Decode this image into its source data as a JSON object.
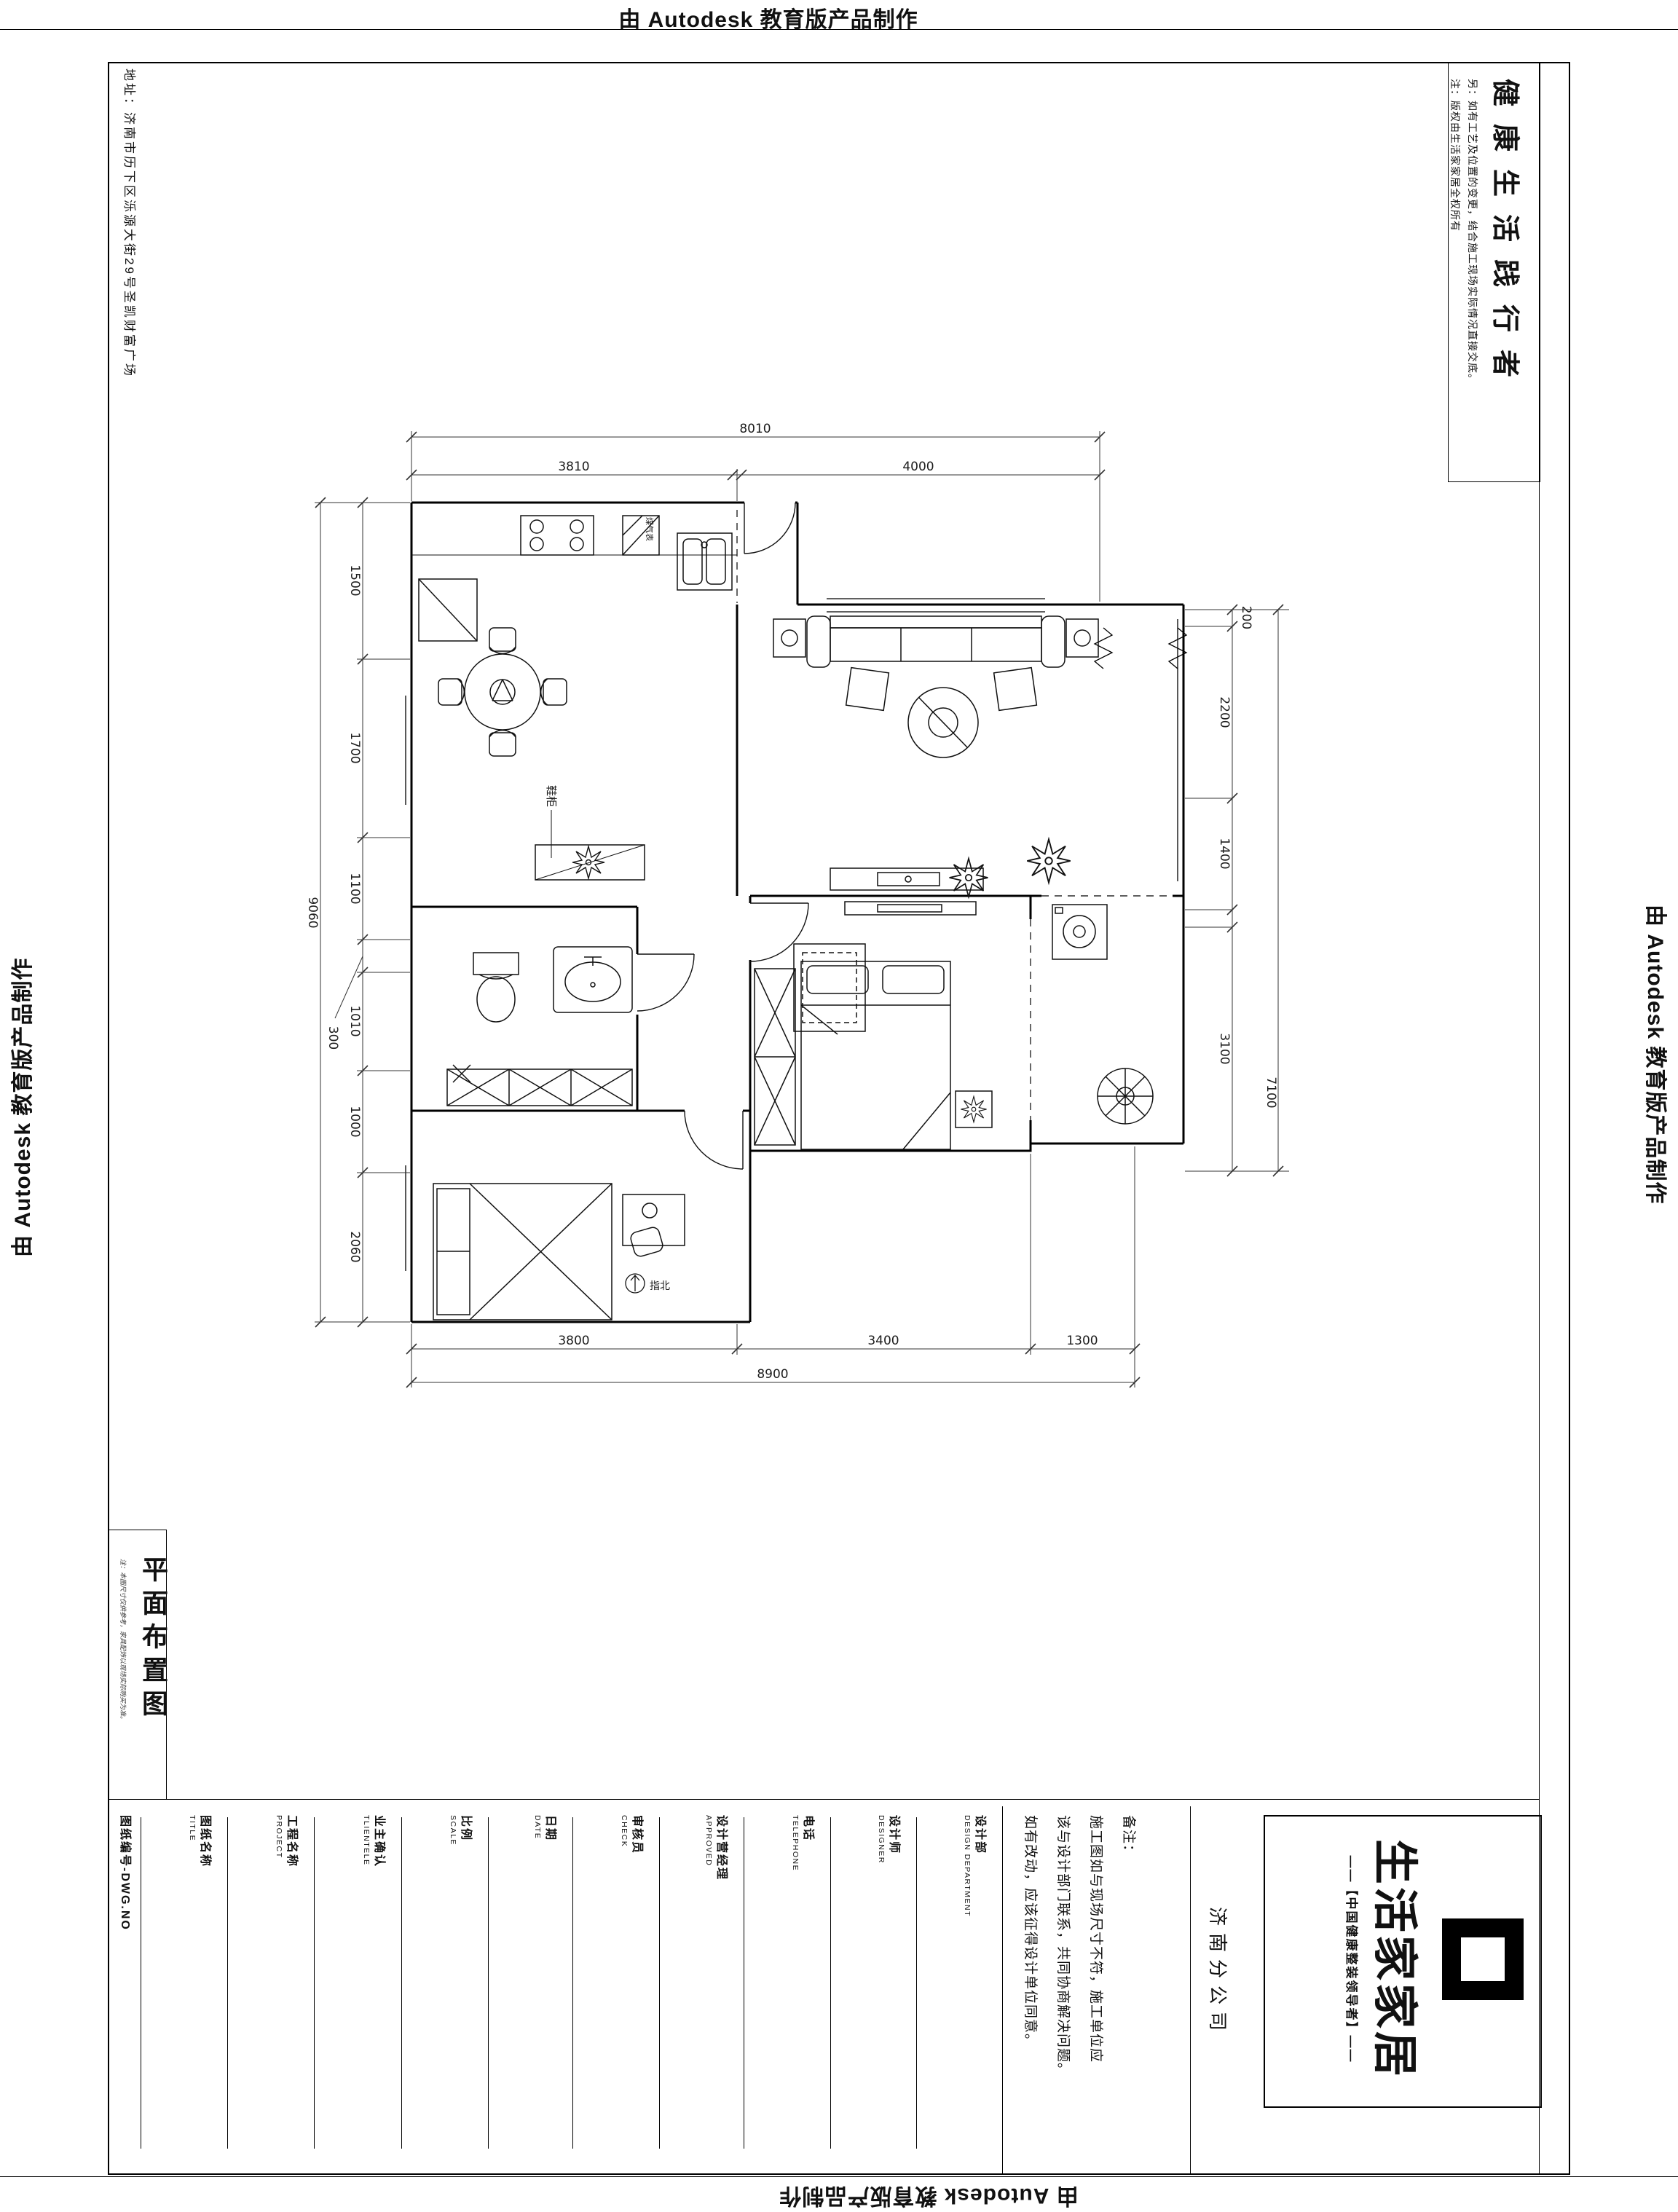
{
  "credit": "由 Autodesk 教育版产品制作",
  "address": "地址：济南市历下区泺源大街29号圣凯财富广场",
  "slogan": {
    "title": "健康生活践行者",
    "note1": "另：如有工艺及位置的变更，结合施工现场实际情况直接交底。",
    "note2": "注：版权由生活家家居全权所有"
  },
  "sidebar": {
    "drawing_title": "平面布置图",
    "note": "注：本图尺寸仅供参考，家具配饰以现场实际购买为准。"
  },
  "plan": {
    "labels": {
      "shoe_cabinet": "鞋柜",
      "gas_meter": "煤气表",
      "north": "指北"
    },
    "dims": {
      "top_total": "8010",
      "top_segs": [
        "3810",
        "4000"
      ],
      "bottom_segs": [
        "3800",
        "3400",
        "1300"
      ],
      "bottom_total": "8900",
      "left_segs": [
        "1500",
        "1700",
        "1100",
        "300",
        "1010",
        "1000",
        "2060"
      ],
      "left_total": "9060",
      "right_segs": [
        "200",
        "2200",
        "1400",
        "3100"
      ],
      "right_total": "7100"
    }
  },
  "titleblock": {
    "fields": [
      {
        "zh": "图纸编号-DWG.NO",
        "en": ""
      },
      {
        "zh": "图纸名称",
        "en": "TITLE"
      },
      {
        "zh": "工程名称",
        "en": "PROJECT"
      },
      {
        "zh": "业主确认",
        "en": "TLIENTELE"
      },
      {
        "zh": "比例",
        "en": "SCALE"
      },
      {
        "zh": "日期",
        "en": "DATE"
      },
      {
        "zh": "审核员",
        "en": "CHECK"
      },
      {
        "zh": "设计营经理",
        "en": "APPROVED"
      },
      {
        "zh": "电话",
        "en": "TELEPHONE"
      },
      {
        "zh": "设计师",
        "en": "DESIGNER"
      },
      {
        "zh": "设计部",
        "en": "DESIGN DEPARTMENT"
      }
    ],
    "remark_title": "备注：",
    "remark_lines": [
      "施工图如与现场尺寸不符，施工单位应",
      "该与设计部门联系，共同协商解决问题。",
      "如有改动，应该征得设计单位同意。"
    ],
    "branch": "济南分公司",
    "logo": {
      "name": "生活家家居",
      "tagline": "——【中国健康整装领导者】——"
    }
  }
}
